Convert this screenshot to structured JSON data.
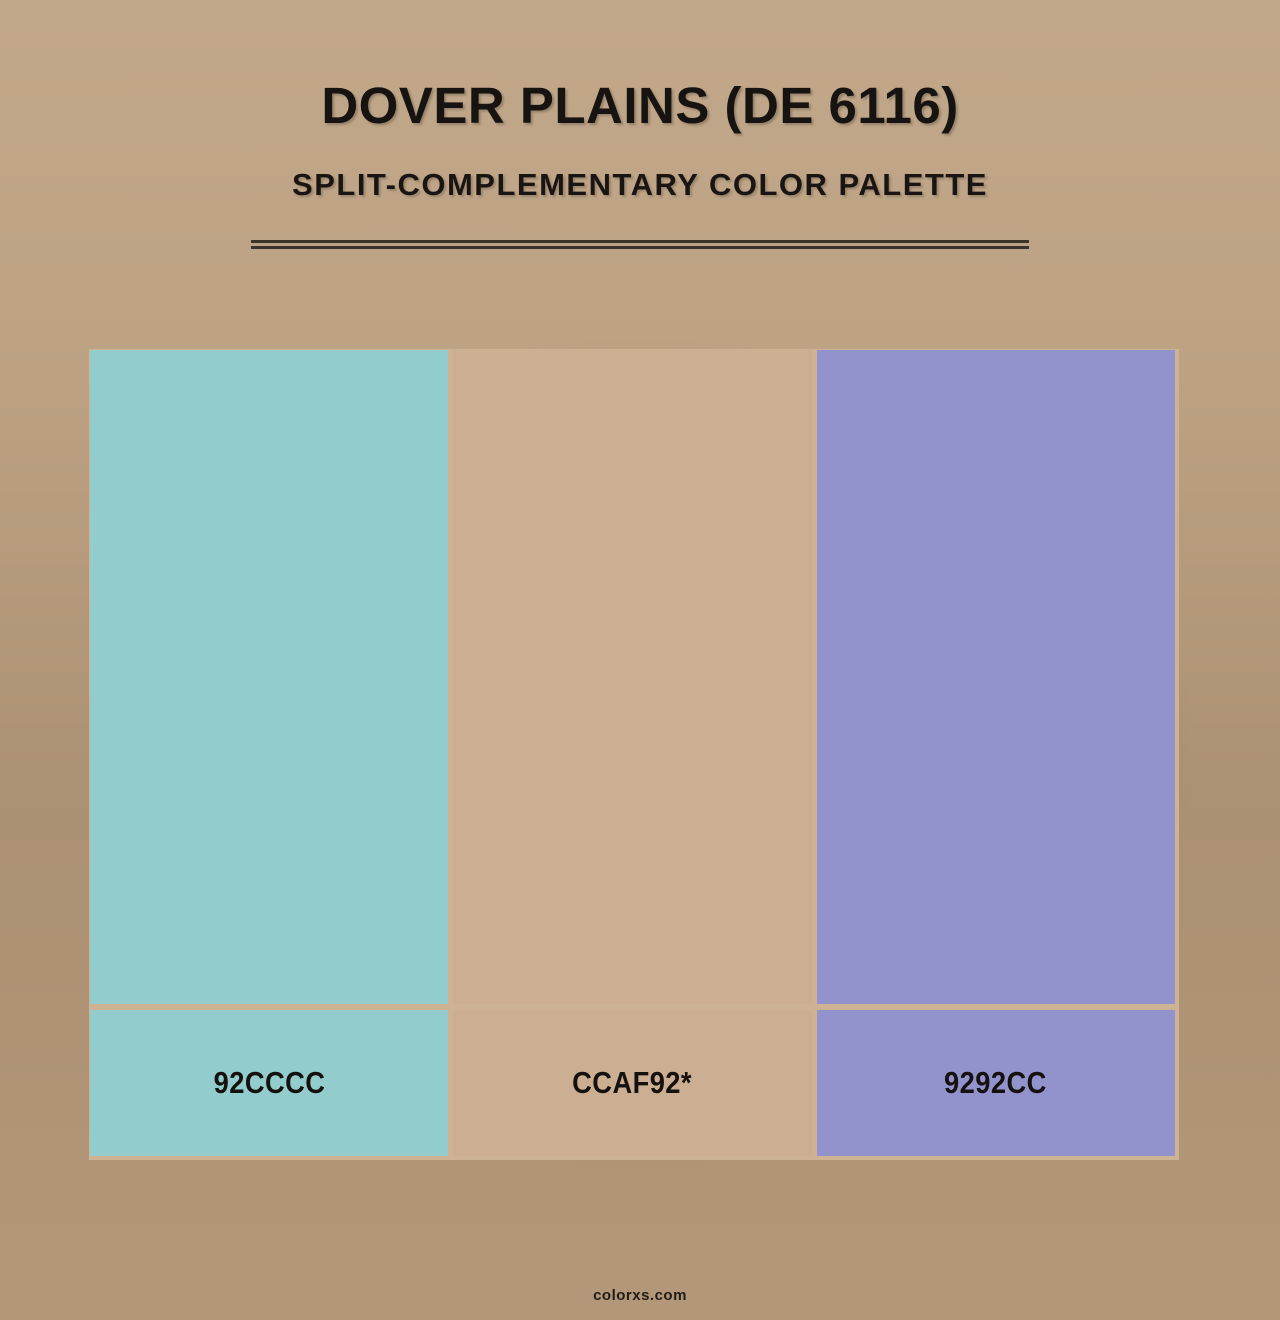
{
  "header": {
    "title": "DOVER PLAINS (DE 6116)",
    "subtitle": "SPLIT-COMPLEMENTARY COLOR PALETTE"
  },
  "palette": {
    "frame_color": "#cdb294",
    "swatches": [
      {
        "label": "92CCCC",
        "hex": "#92CCCC"
      },
      {
        "label": "CCAF92*",
        "hex": "#CCAF92"
      },
      {
        "label": "9292CC",
        "hex": "#9292CC"
      }
    ]
  },
  "footer": {
    "site": "colorxs.com"
  },
  "theme": {
    "text_color": "#171310",
    "divider_color": "#3c342b",
    "background_light": "#c2a88a",
    "background_dark": "#9b8164"
  }
}
